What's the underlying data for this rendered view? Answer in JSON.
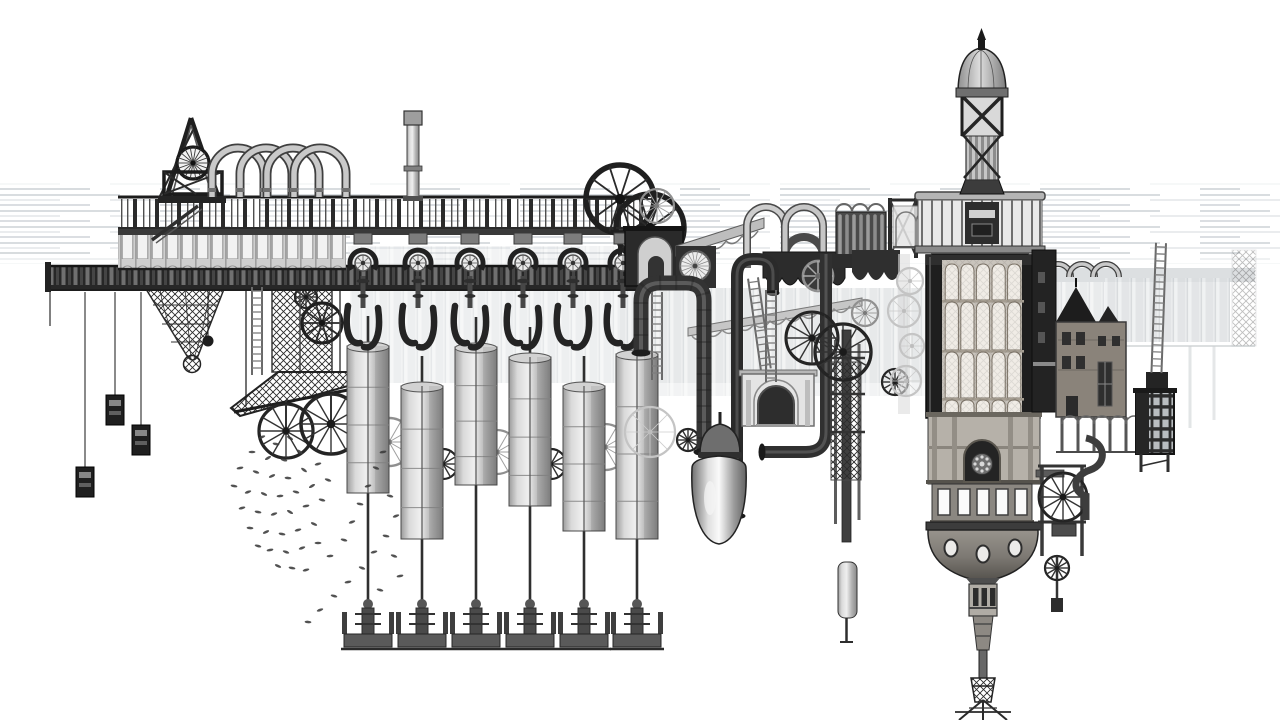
{
  "artwork": {
    "title": "Monochrome engraving-style illustration of a fantastical floating steampunk factory",
    "style": "black-and-white etching collage",
    "background": "#ffffff"
  },
  "palette": {
    "paper": "#ffffff",
    "ink": "#161616",
    "dark": "#2e2e2e",
    "mid": "#6f6f6f",
    "steel": "#9a9a9a",
    "light": "#c9c9c9",
    "pale": "#dedede",
    "ghost": "#e7e9ea",
    "sky": "#d5dade"
  },
  "scene": {
    "fish_swarm": [
      [
        262,
        437,
        -20
      ],
      [
        276,
        444,
        10
      ],
      [
        290,
        438,
        30
      ],
      [
        252,
        452,
        0
      ],
      [
        268,
        458,
        -30
      ],
      [
        284,
        460,
        15
      ],
      [
        300,
        452,
        40
      ],
      [
        240,
        468,
        -10
      ],
      [
        256,
        472,
        20
      ],
      [
        272,
        476,
        -25
      ],
      [
        288,
        478,
        5
      ],
      [
        304,
        470,
        35
      ],
      [
        318,
        464,
        -15
      ],
      [
        234,
        486,
        10
      ],
      [
        248,
        492,
        -20
      ],
      [
        264,
        494,
        25
      ],
      [
        280,
        496,
        -5
      ],
      [
        296,
        492,
        15
      ],
      [
        312,
        486,
        -30
      ],
      [
        328,
        480,
        20
      ],
      [
        242,
        508,
        -15
      ],
      [
        258,
        512,
        10
      ],
      [
        274,
        514,
        -20
      ],
      [
        290,
        512,
        30
      ],
      [
        306,
        506,
        -10
      ],
      [
        322,
        500,
        15
      ],
      [
        250,
        528,
        5
      ],
      [
        266,
        532,
        -25
      ],
      [
        282,
        534,
        10
      ],
      [
        298,
        530,
        -15
      ],
      [
        314,
        524,
        25
      ],
      [
        258,
        546,
        15
      ],
      [
        270,
        550,
        -10
      ],
      [
        286,
        552,
        20
      ],
      [
        302,
        548,
        -20
      ],
      [
        318,
        543,
        0
      ],
      [
        278,
        566,
        25
      ],
      [
        292,
        568,
        10
      ],
      [
        306,
        570,
        -15
      ],
      [
        330,
        556,
        -5
      ],
      [
        344,
        540,
        15
      ],
      [
        352,
        522,
        -20
      ],
      [
        360,
        504,
        10
      ],
      [
        368,
        486,
        -15
      ],
      [
        376,
        468,
        20
      ],
      [
        383,
        452,
        -10
      ],
      [
        390,
        496,
        15
      ],
      [
        396,
        516,
        -20
      ],
      [
        386,
        536,
        10
      ],
      [
        374,
        552,
        -15
      ],
      [
        362,
        568,
        20
      ],
      [
        348,
        582,
        -10
      ],
      [
        334,
        596,
        15
      ],
      [
        320,
        610,
        -20
      ],
      [
        308,
        622,
        5
      ],
      [
        394,
        556,
        20
      ],
      [
        400,
        576,
        -10
      ],
      [
        380,
        590,
        15
      ]
    ],
    "cylinders": {
      "centers": [
        368,
        422,
        476,
        530,
        584,
        637
      ],
      "tops": [
        342,
        382,
        343,
        353,
        382,
        350
      ],
      "bottoms": [
        493,
        539,
        485,
        506,
        531,
        539
      ]
    },
    "pumps": [
      363,
      418,
      470,
      523,
      573,
      623
    ],
    "cable_cars": [
      [
        85,
        467
      ],
      [
        115,
        395
      ],
      [
        141,
        425
      ]
    ],
    "arch_loops": [
      {
        "layer": "arch-loops",
        "centers": [
          238,
          266,
          293,
          320
        ],
        "r": 26,
        "base": 174,
        "leg": 197,
        "out": 9,
        "core": 5.5,
        "ped": true
      },
      {
        "layer": "loops-right",
        "centers": [
          1058,
          1082,
          1106
        ],
        "r": 13,
        "base": 277,
        "leg": 277,
        "out": 6,
        "core": 3.5,
        "ped": false
      }
    ],
    "wheels": [
      [
        620,
        199,
        34,
        "dark",
        "layer-flywheels"
      ],
      [
        650,
        228,
        34,
        "dark",
        "layer-flywheels"
      ],
      [
        657,
        206,
        17,
        "light",
        "layer-flywheels"
      ],
      [
        193,
        163,
        16,
        "head",
        "layer-headwheel"
      ],
      [
        306,
        297,
        11,
        "darkthin",
        "layer-gantry"
      ],
      [
        322,
        323,
        20,
        "dark",
        "layer-gantry"
      ],
      [
        286,
        431,
        27,
        "darkthin",
        "layer-gantry2"
      ],
      [
        331,
        424,
        30,
        "darkthin",
        "layer-gantry2"
      ],
      [
        389,
        442,
        24,
        "light",
        "layer-cylwheels"
      ],
      [
        497,
        452,
        22,
        "light",
        "layer-cylwheels"
      ],
      [
        605,
        447,
        23,
        "light",
        "layer-cylwheels"
      ],
      [
        443,
        464,
        15,
        "darkthin",
        "layer-cylwheels"
      ],
      [
        551,
        464,
        15,
        "darkthin",
        "layer-cylwheels"
      ],
      [
        650,
        432,
        25,
        "ghost",
        "layer-mazelow"
      ],
      [
        688,
        440,
        11,
        "darkthin",
        "layer-mazelow"
      ],
      [
        695,
        266,
        15,
        "sun",
        "layer-sunwheel"
      ],
      [
        818,
        276,
        15,
        "gear",
        "layer-scallopgear"
      ],
      [
        812,
        338,
        26,
        "darkthin",
        "layer-mazewheels"
      ],
      [
        843,
        352,
        28,
        "darkthin",
        "layer-mazewheels"
      ],
      [
        895,
        382,
        13,
        "darkthin",
        "layer-mazewheels"
      ],
      [
        865,
        313,
        13,
        "light",
        "layer-mazewheels"
      ],
      [
        910,
        281,
        13,
        "ghost",
        "layer-towerghost"
      ],
      [
        904,
        311,
        16,
        "ghost",
        "layer-towerghost"
      ],
      [
        912,
        346,
        12,
        "ghost",
        "layer-towerghost"
      ],
      [
        906,
        381,
        15,
        "ghost",
        "layer-towerghost"
      ],
      [
        1063,
        497,
        24,
        "darkthin",
        "layer-engine-flywheel"
      ],
      [
        1057,
        568,
        12,
        "darkthin",
        "layer-engine-governor"
      ]
    ],
    "ladders": [
      [
        753,
        278,
        92,
        -8
      ],
      [
        771,
        290,
        92,
        0
      ],
      [
        657,
        292,
        88,
        0
      ],
      [
        257,
        287,
        88,
        0
      ],
      [
        1161,
        243,
        130,
        2
      ]
    ],
    "tower_cutaway": {
      "x": 944,
      "w": 78,
      "cols": 5,
      "tiers": [
        [
          264,
          36
        ],
        [
          302,
          48
        ],
        [
          352,
          46
        ],
        [
          400,
          14
        ]
      ]
    }
  }
}
